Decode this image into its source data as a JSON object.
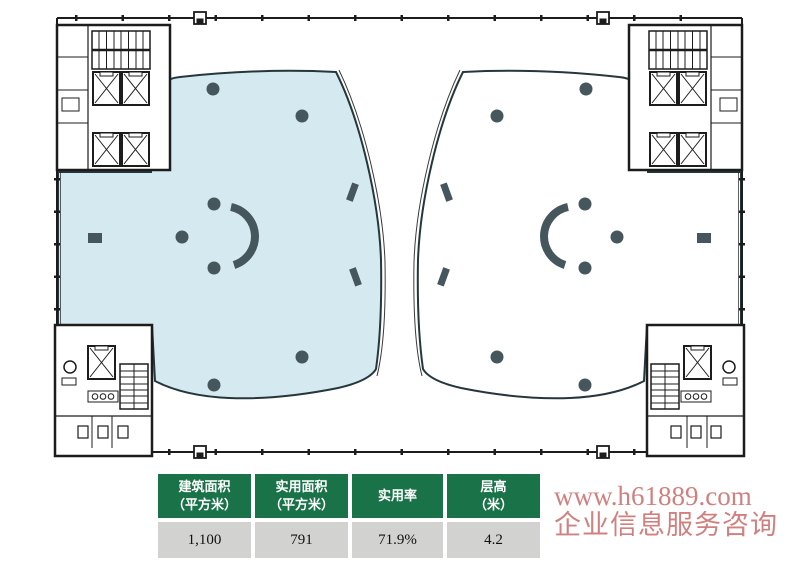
{
  "floor_plan": {
    "label": "office-tower-typical-floor-plan",
    "colors": {
      "highlight_fill": "#d5eaf0",
      "plate_outline": "#26373c",
      "structure": "#45565d",
      "line": "#1c1c1c"
    }
  },
  "table": {
    "columns": [
      {
        "header_line1": "建筑面积",
        "header_line2": "（平方米）",
        "value": "1,100"
      },
      {
        "header_line1": "实用面积",
        "header_line2": "（平方米）",
        "value": "791"
      },
      {
        "header_line1": "实用率",
        "header_line2": "",
        "value": "71.9%"
      },
      {
        "header_line1": "层高",
        "header_line2": "（米）",
        "value": "4.2"
      }
    ],
    "style": {
      "header_bg": "#1a7248",
      "header_text": "#ffffff",
      "value_bg": "#d2d2d0",
      "value_text": "#111111"
    }
  },
  "watermark": {
    "line1": "www.h61889.com",
    "line2": "企业信息服务咨询",
    "color": "#c96b6b"
  }
}
